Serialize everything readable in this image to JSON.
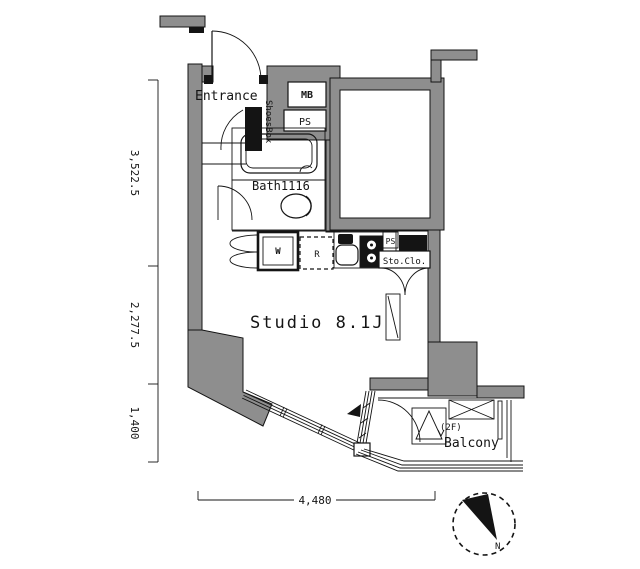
{
  "floor_plan": {
    "unit_labels": {
      "entrance": "Entrance",
      "shoes_box": "ShoesBox",
      "meter_box": "MB",
      "pipe_space_upper": "PS",
      "bath": "Bath1116",
      "washer_symbol": "W",
      "fridge_symbol": "R",
      "pipe_space_kitchen": "PS",
      "storage_closet": "Sto.Clo.",
      "studio": "Studio 8.1J",
      "balcony_floor_note": "(2F)",
      "balcony": "Balcony",
      "north_mark": "N"
    },
    "dimensions": {
      "left_upper": "3,522.5",
      "left_middle": "2,277.5",
      "left_lower": "1,400",
      "bottom_width": "4,480"
    },
    "colors": {
      "wall_fill": "#8e8e8e",
      "line": "#141414",
      "background": "#ffffff"
    }
  }
}
